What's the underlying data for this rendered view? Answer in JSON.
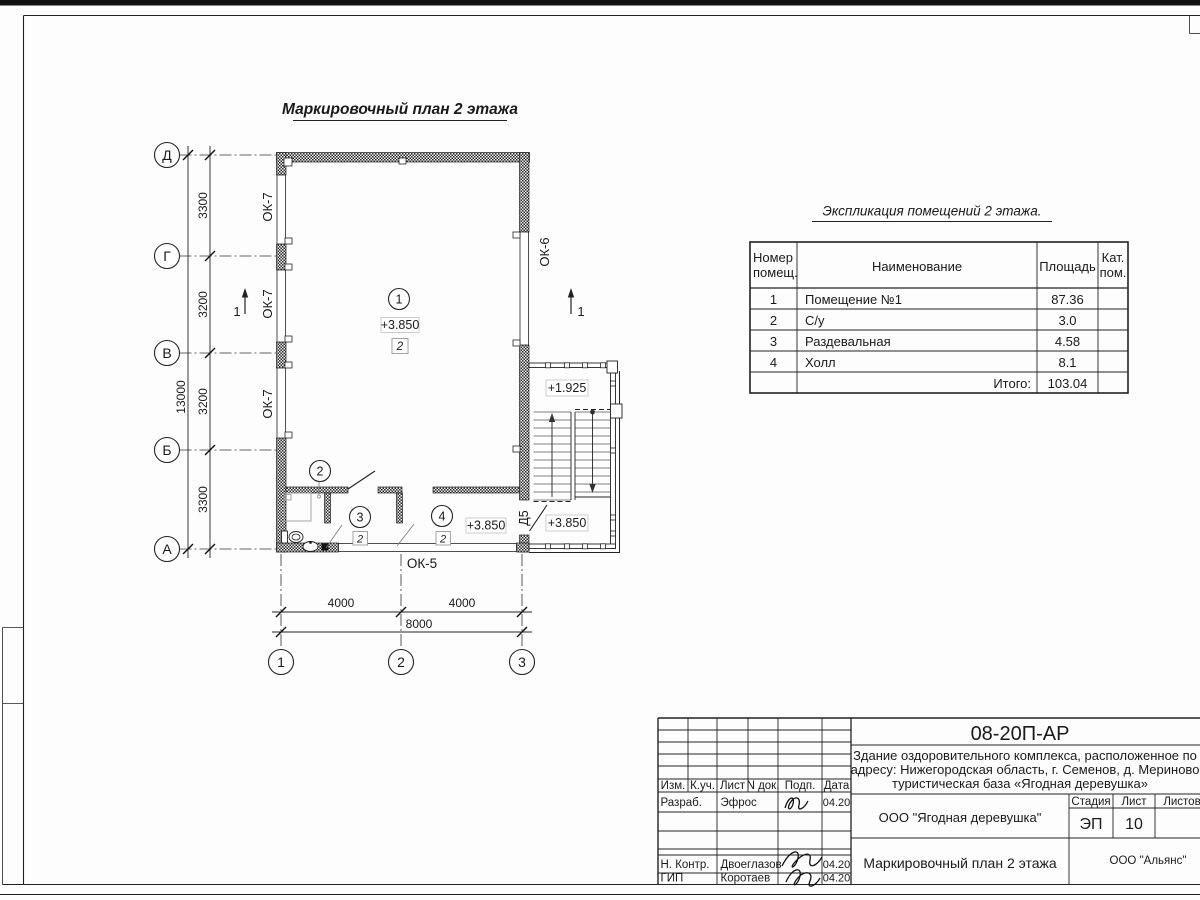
{
  "sheet": {
    "plan_title": "Маркировочный план 2 этажа"
  },
  "axes": {
    "rows": [
      "Д",
      "Г",
      "В",
      "Б",
      "А"
    ],
    "cols": [
      "1",
      "2",
      "3"
    ]
  },
  "dims": {
    "row_segments": [
      "3300",
      "3200",
      "3200",
      "3300"
    ],
    "row_total": "13000",
    "col_segments": [
      "4000",
      "4000"
    ],
    "col_total": "8000"
  },
  "plan": {
    "window_ok7": "ОК-7",
    "window_ok6": "ОК-6",
    "window_ok5": "ОК-5",
    "door_d5": "Д5",
    "room_numbers": [
      "1",
      "2",
      "3",
      "4"
    ],
    "finish_mark": "2",
    "section_mark": "1",
    "elev_room1": "+3.850",
    "elev_landing": "+1.925",
    "elev_stair_lower": "+3.850",
    "elev_hall": "+3.850"
  },
  "explication": {
    "title": "Экспликация помещений 2 этажа.",
    "col_num_1": "Номер",
    "col_num_2": "помещ.",
    "col_name": "Наименование",
    "col_area": "Площадь",
    "col_cat_1": "Кат.",
    "col_cat_2": "пом.",
    "rows": [
      {
        "num": "1",
        "name": "Помещение №1",
        "area": "87.36"
      },
      {
        "num": "2",
        "name": "С/у",
        "area": "3.0"
      },
      {
        "num": "3",
        "name": "Раздевальная",
        "area": "4.58"
      },
      {
        "num": "4",
        "name": "Холл",
        "area": "8.1"
      }
    ],
    "total_label": "Итого:",
    "total_value": "103.04"
  },
  "title_block": {
    "code": "08-20П-АР",
    "project_line1": "Здание оздоровительного комплекса, расположенное по",
    "project_line2": "адресу: Нижегородская область, г. Семенов, д. Мериново",
    "project_line3": "туристическая база «Ягодная деревушка»",
    "col_izm": "Изм.",
    "col_kuch": "К.уч.",
    "col_list": "Лист",
    "col_ndok": "N док.",
    "col_podp": "Подп.",
    "col_data": "Дата",
    "row_razrab_label": "Разраб.",
    "row_razrab_name": "Эфрос",
    "row_razrab_date": "04.20",
    "row_nkontr_label": "Н. Контр.",
    "row_nkontr_name": "Двоеглазов",
    "row_nkontr_date": "04.20",
    "row_gip_label": "ГИП",
    "row_gip_name": "Коротаев",
    "row_gip_date": "04.20",
    "customer": "ООО \"Ягодная деревушка\"",
    "stage_label": "Стадия",
    "sheet_label": "Лист",
    "sheets_label": "Листов",
    "stage_value": "ЭП",
    "sheet_value": "10",
    "doc_title": "Маркировочный план 2 этажа",
    "org": "ООО \"Альянс\""
  }
}
